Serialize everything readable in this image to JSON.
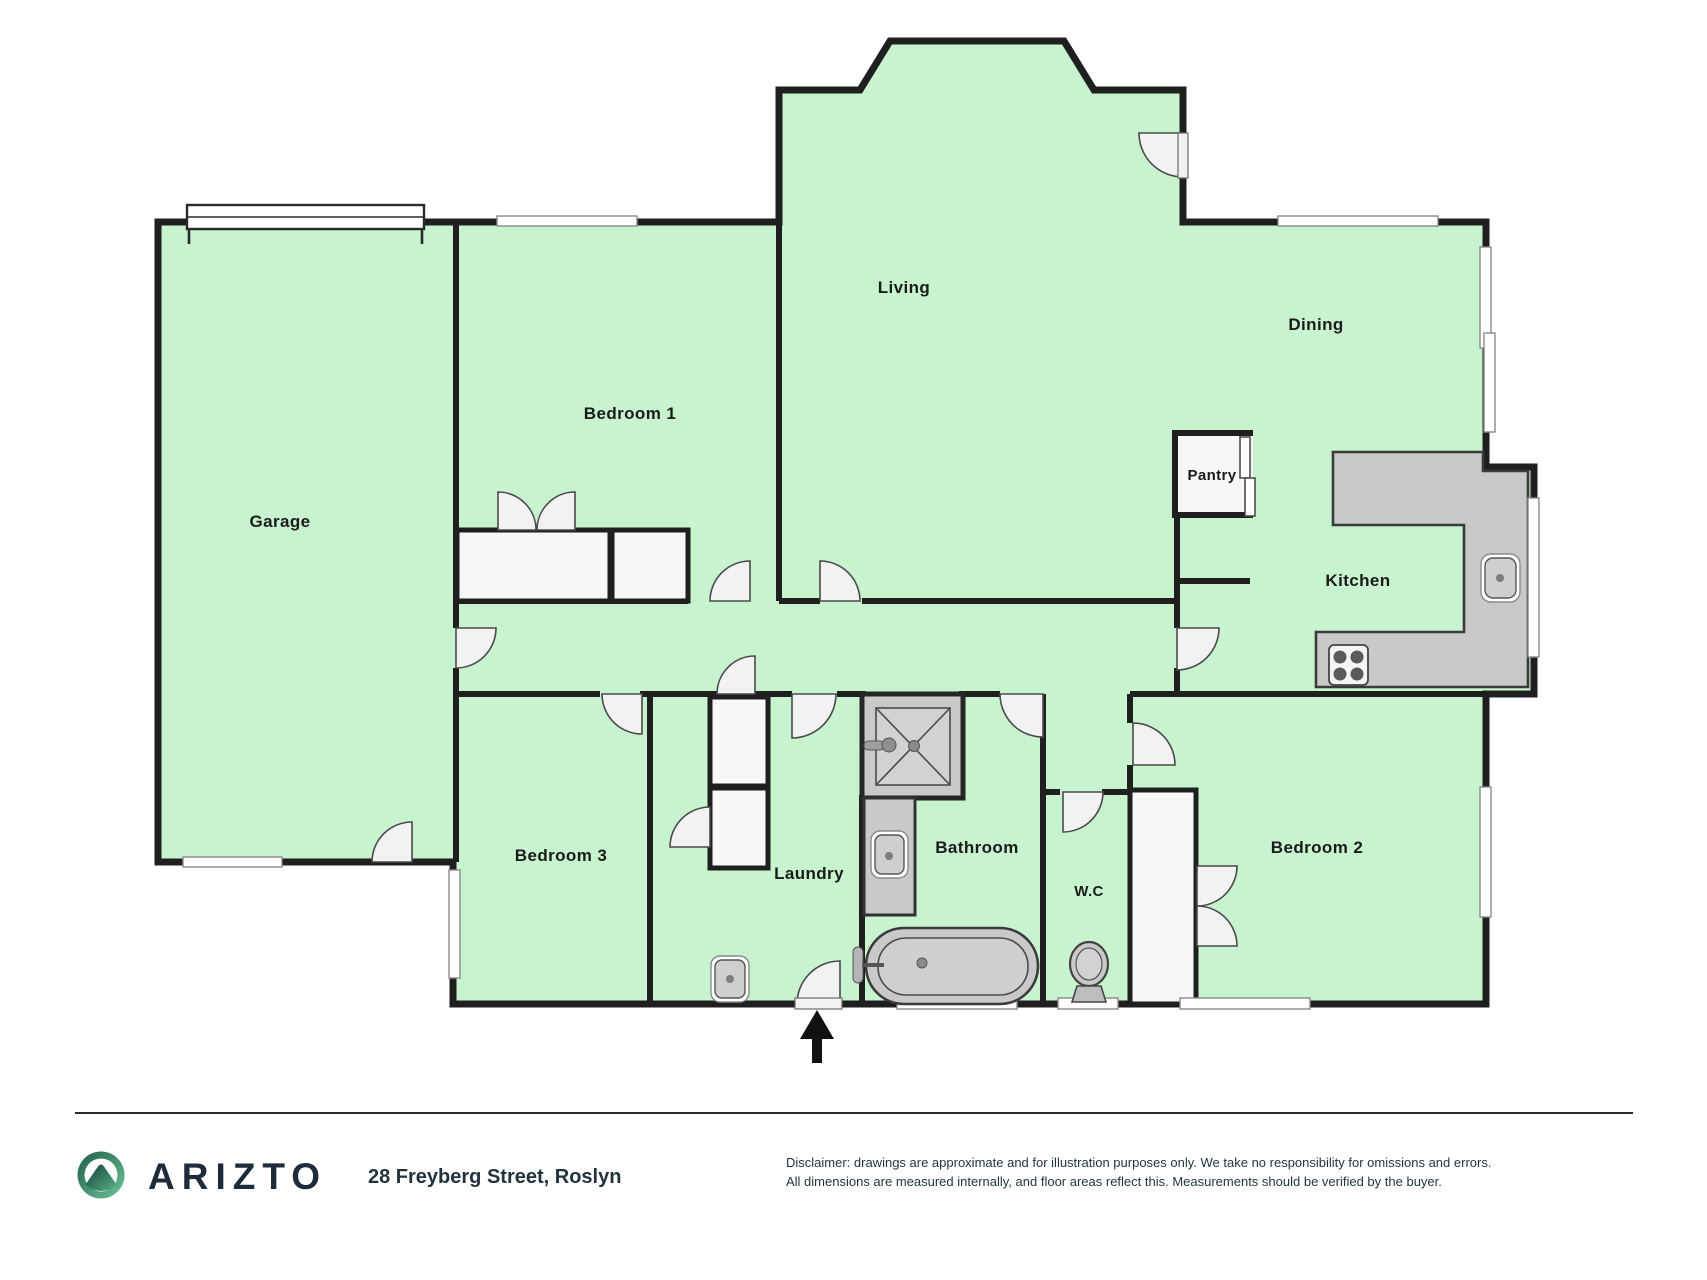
{
  "brand": {
    "name": "ARIZTO"
  },
  "property": {
    "address": "28 Freyberg Street, Roslyn"
  },
  "rooms": [
    {
      "id": "garage",
      "label": "Garage"
    },
    {
      "id": "bedroom-1",
      "label": "Bedroom 1"
    },
    {
      "id": "living",
      "label": "Living"
    },
    {
      "id": "dining",
      "label": "Dining"
    },
    {
      "id": "pantry",
      "label": "Pantry"
    },
    {
      "id": "kitchen",
      "label": "Kitchen"
    },
    {
      "id": "bedroom-3",
      "label": "Bedroom 3"
    },
    {
      "id": "laundry",
      "label": "Laundry"
    },
    {
      "id": "bathroom",
      "label": "Bathroom"
    },
    {
      "id": "wc",
      "label": "W.C"
    },
    {
      "id": "bedroom-2",
      "label": "Bedroom 2"
    }
  ],
  "disclaimer": {
    "line1": "Disclaimer: drawings are approximate and for illustration purposes only. We take no responsibility for omissions and errors.",
    "line2": "All dimensions are measured internally, and floor areas reflect this. Measurements should be verified by the buyer."
  },
  "colors": {
    "floor": "#c7f3cf",
    "wall": "#1f1f1f",
    "fixture": "#c9c9c9",
    "door": "#f2f2f2",
    "logo_teal": "#2a7a5f",
    "brand_text": "#1d2b3a"
  }
}
